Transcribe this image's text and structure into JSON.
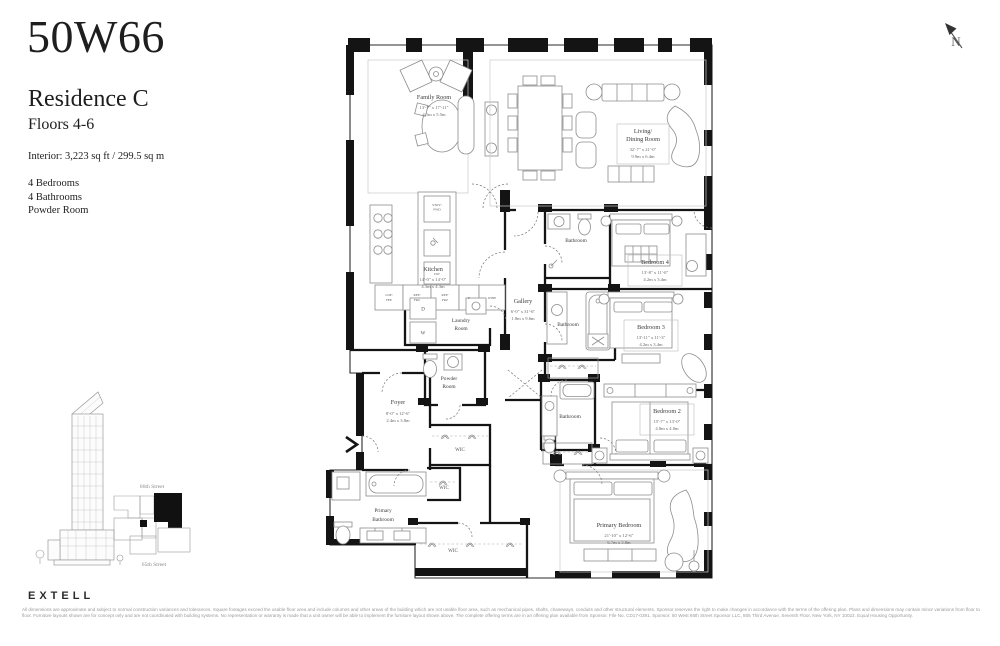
{
  "header": {
    "brand": "50W66",
    "residence": "Residence C",
    "floors": "Floors 4-6",
    "interior": "Interior: 3,223 sq ft / 299.5 sq m",
    "features": [
      "4 Bedrooms",
      "4 Bathrooms",
      "Powder Room"
    ]
  },
  "compass": {
    "label": "N"
  },
  "rooms": {
    "family": {
      "name": "Family Room",
      "imperial": "13'-7\" x 17'-11\"",
      "metric": "4.1m x 5.5m"
    },
    "living": {
      "name1": "Living/",
      "name2": "Dining Room",
      "imperial": "32'-7\" x 21'-0\"",
      "metric": "9.9m x 6.4m"
    },
    "kitchen": {
      "name": "Kitchen",
      "imperial": "14'-0\" x 14'-0\"",
      "metric": "4.3m x 4.3m"
    },
    "laundry": {
      "name1": "Laundry",
      "name2": "Room"
    },
    "gallery": {
      "name": "Gallery",
      "imperial": "6'-0\" x 31'-6\"",
      "metric": "1.8m x 9.6m"
    },
    "powder": {
      "name1": "Powder",
      "name2": "Room"
    },
    "bath1": {
      "name": "Bathroom"
    },
    "bath2": {
      "name": "Bathroom"
    },
    "bath3": {
      "name": "Bathroom"
    },
    "bed4": {
      "name": "Bedroom 4",
      "imperial": "13'-8\" x 11'-0\"",
      "metric": "4.2m x 3.4m"
    },
    "bed3": {
      "name": "Bedroom 3",
      "imperial": "13'-11\" x 11'-3\"",
      "metric": "4.2m x 3.4m"
    },
    "bed2": {
      "name": "Bedroom 2",
      "imperial": "15'-7\" x 13'-0\"",
      "metric": "4.8m x 4.0m"
    },
    "primary_bed": {
      "name": "Primary Bedroom",
      "imperial": "21'-10\" x 12'-6\"",
      "metric": "6.7m x 3.8m"
    },
    "primary_bath": {
      "name1": "Primary",
      "name2": "Bathroom"
    },
    "foyer": {
      "name": "Foyer",
      "imperial": "8'-0\" x 12'-6\"",
      "metric": "2.4m x 3.8m"
    },
    "wic1": {
      "name": "WIC"
    },
    "wic2": {
      "name": "WIC"
    },
    "wic3": {
      "name": "WIC"
    }
  },
  "appliances": {
    "stove1": "STOV/",
    "stove2": "FWD",
    "dw": "DW",
    "coffee1": "COF/",
    "coffee2": "FEE",
    "ref1": "REF/",
    "ref2": "FRZ",
    "f": "F",
    "wine": "WINE",
    "washer": "W",
    "dryer": "D"
  },
  "keyplan": {
    "street_top": "66th Street",
    "street_bottom": "65th Street"
  },
  "footer": {
    "logo": "EXTELL",
    "disclaimer": "All dimensions are approximate and subject to normal construction variances and tolerances. Square footages exceed the usable floor area and include columns and other areas of the building which are not usable floor area, such as mechanical pipes, shafts, chaseways, conduits and other structural elements. Sponsor reserves the right to make changes in accordance with the terms of the offering plan. Plans and dimensions may contain minor variations from floor to floor. Furniture layouts shown are for concept only and are not coordinated with building systems. No representation or warranty is made that a unit owner will be able to implement the furniture layout shown above. The complete offering terms are in an offering plan available from Sponsor. File No. CD17-0391. Sponsor: 50 West 66th Street Sponsor LLC, 805 Third Avenue, Seventh Floor, New York, NY 10022. Equal Housing Opportunity."
  }
}
